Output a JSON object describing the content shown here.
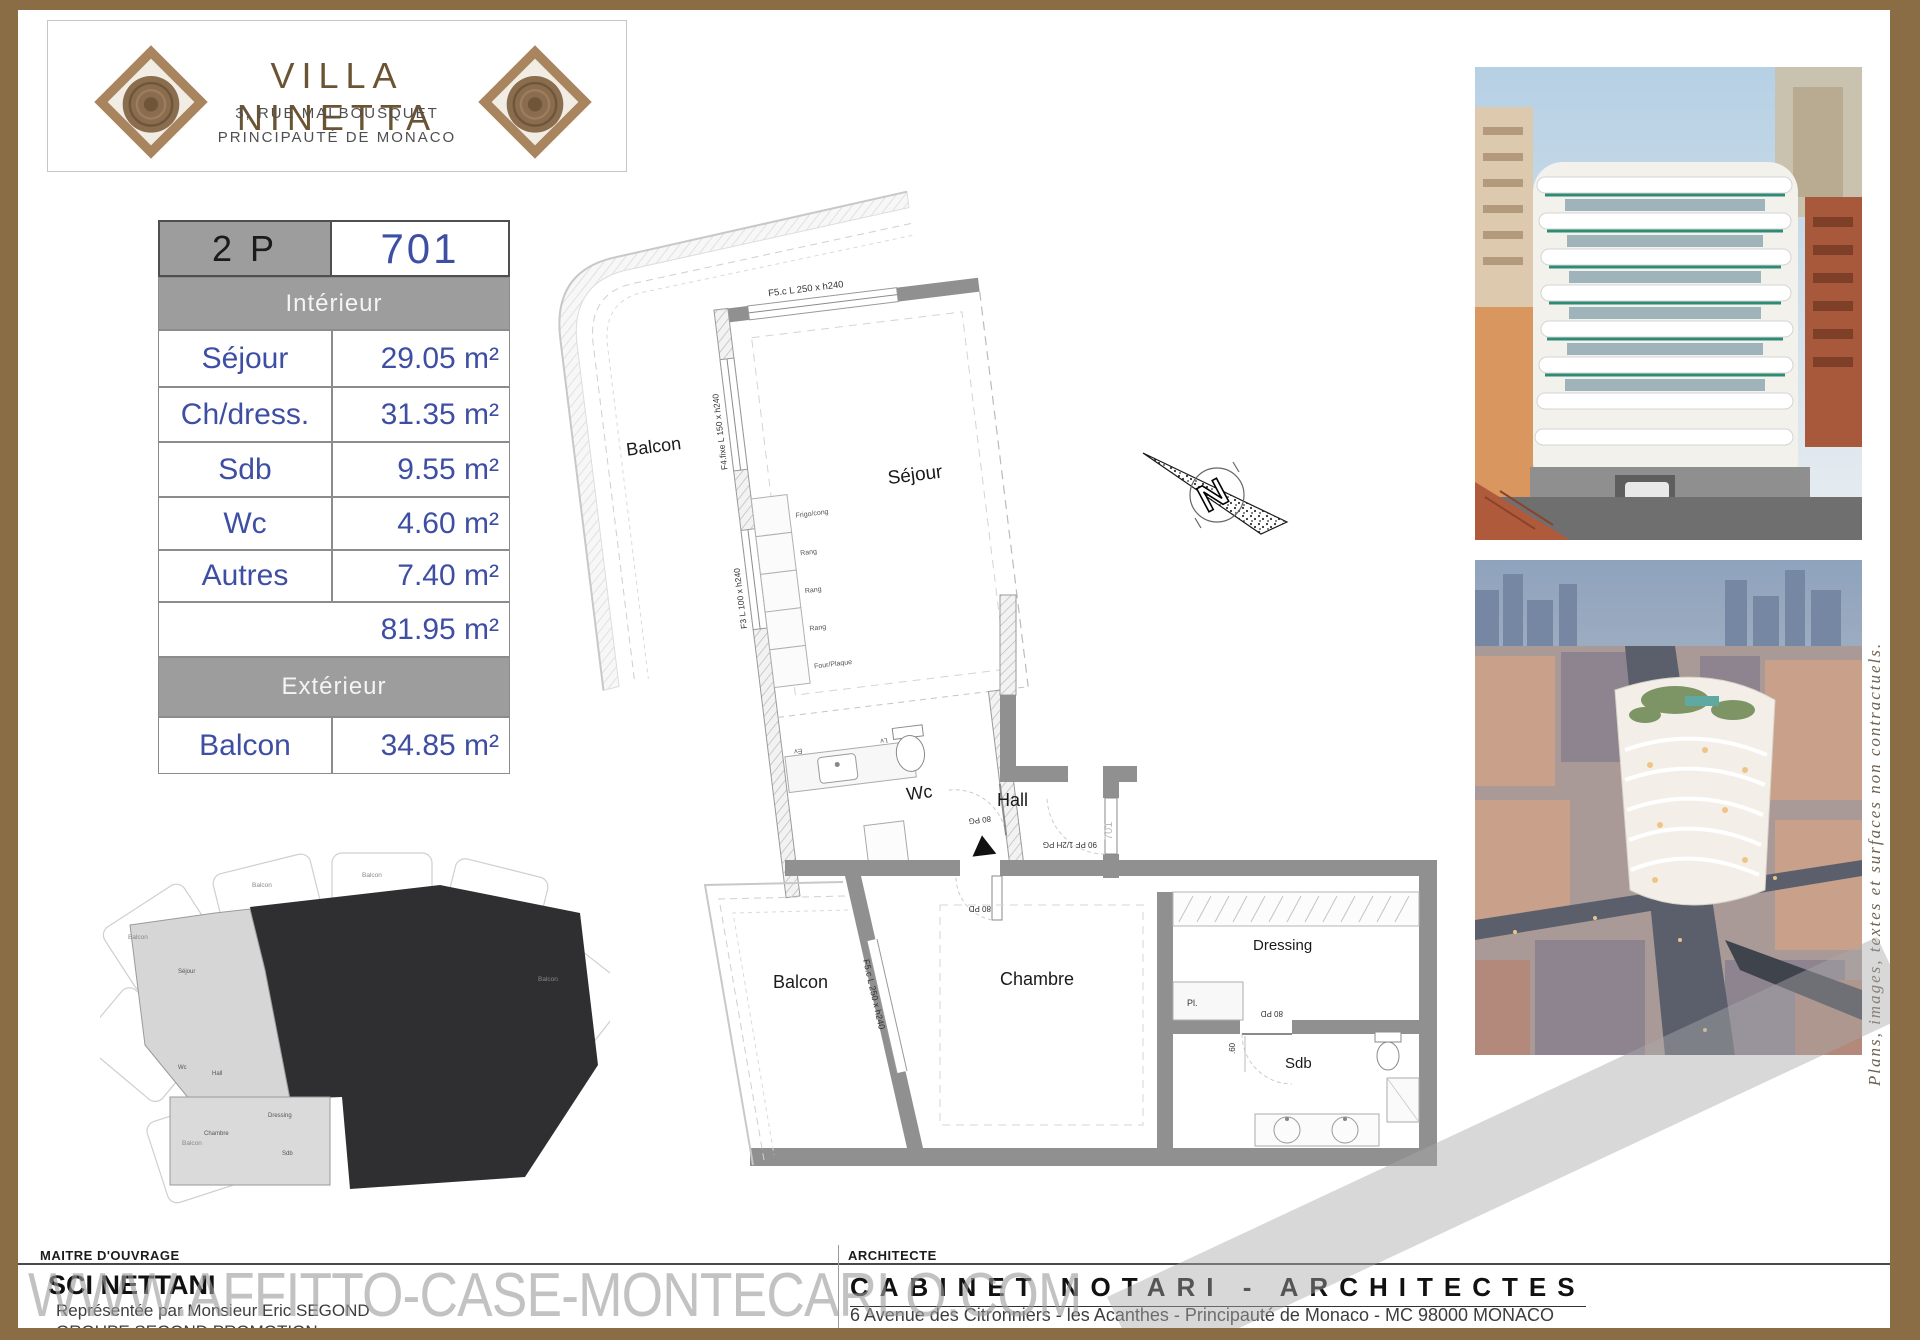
{
  "page": {
    "watermark_text": "WWW.AFFITTO-CASE-MONTECARLO.COM",
    "side_note": "Plans, images, textes et surfaces non contractuels.",
    "frame_color": "#8a6d45"
  },
  "header": {
    "title": "VILLA NINETTA",
    "address_line1": "3, RUE MALBOUSQUET",
    "address_line2": "PRINCIPAUTÉ DE MONACO"
  },
  "area_table": {
    "type_label": "2 P",
    "lot_number": "701",
    "interior_header": "Intérieur",
    "exterior_header": "Extérieur",
    "interior_rows": [
      {
        "label": "Séjour",
        "value": "29.05 m²"
      },
      {
        "label": "Ch/dress.",
        "value": "31.35 m²"
      },
      {
        "label": "Sdb",
        "value": "9.55 m²"
      },
      {
        "label": "Wc",
        "value": "4.60 m²"
      },
      {
        "label": "Autres",
        "value": "7.40 m²"
      }
    ],
    "interior_total": "81.95 m²",
    "exterior_row": {
      "label": "Balcon",
      "value": "34.85 m²"
    },
    "accent_color": "#3e4fa3",
    "header_bg": "#9d9d9d"
  },
  "floor_plan": {
    "north_label": "N",
    "rooms": {
      "balcon_top": "Balcon",
      "sejour": "Séjour",
      "wc": "Wc",
      "hall": "Hall",
      "balcon_bottom": "Balcon",
      "chambre": "Chambre",
      "dressing": "Dressing",
      "sdb": "Sdb"
    },
    "windows": {
      "sejour_top": "F5.c L 250 x h240",
      "sejour_left_fixed": "F4.fixe L 150 x h240",
      "sejour_left_low": "F3 L 100 x h240",
      "chambre": "F5.c L 250 x h240"
    },
    "doors": {
      "wc": "80 PG",
      "entry": "90 PF 1/2H PG",
      "entry_unit": "701",
      "chambre": "80 PD",
      "sdb": "80 PD"
    },
    "kitchen": {
      "fridge": "Frigo/cong",
      "storage1": "Rang",
      "storage2": "Rang",
      "storage3": "Rang",
      "oven": "Four/Plaque",
      "sink": "Ev",
      "dishwasher": "Lv",
      "washer": "LL"
    },
    "annotations": {
      "closet": "Pl.",
      "dim": ".60"
    }
  },
  "mini_plan": {
    "balcon": "Balcon",
    "sejour": "Séjour",
    "wc": "Wc",
    "hall": "Hall",
    "chambre": "Chambre",
    "dressing": "Dressing",
    "sdb": "Sdb"
  },
  "footer": {
    "owner_section_label": "MAITRE D'OUVRAGE",
    "owner_name": "SCI NETTANI",
    "owner_line1": "Représentée par Monsieur Eric SEGOND",
    "owner_line2": "GROUPE SEGOND PROMOTION",
    "owner_line3": "45 Rue Grimaldi - 98 000 Monaco  -  Tél: +377.92.05.35.77",
    "architect_section_label": "ARCHITECTE",
    "architect_name": "CABINET NOTARI - ARCHITECTES",
    "architect_line1": "6 Avenue des Citronniers - les Acanthes - Principauté de Monaco - MC 98000 MONACO",
    "architect_line2": "Tél: +377.93.50.09.80"
  }
}
